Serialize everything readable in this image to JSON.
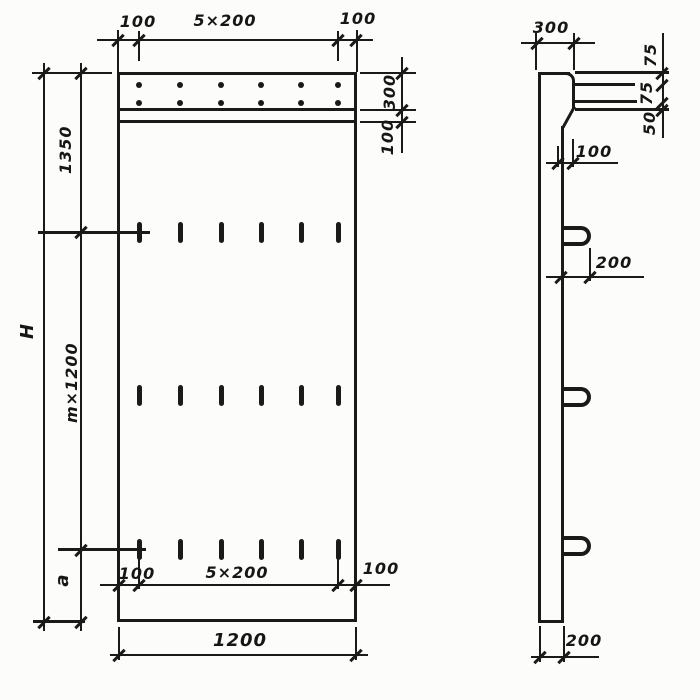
{
  "front_view": {
    "top": {
      "left": "100",
      "center": "5×200",
      "right": "100"
    },
    "right": {
      "band_height": "300",
      "strip_height": "100"
    },
    "left": {
      "top_to_first_loop": "1350",
      "total_height": "H",
      "loop_zone": "m×1200",
      "bottom_margin": "a"
    },
    "bottom": {
      "left": "100",
      "center": "5×200",
      "right": "100",
      "overall_width": "1200"
    }
  },
  "side_view": {
    "top_thickness": "300",
    "right": {
      "seg1": "75",
      "seg2": "75",
      "seg3": "50"
    },
    "ledge_depth": "100",
    "loop_extent": "200",
    "bottom_thickness": "200"
  }
}
